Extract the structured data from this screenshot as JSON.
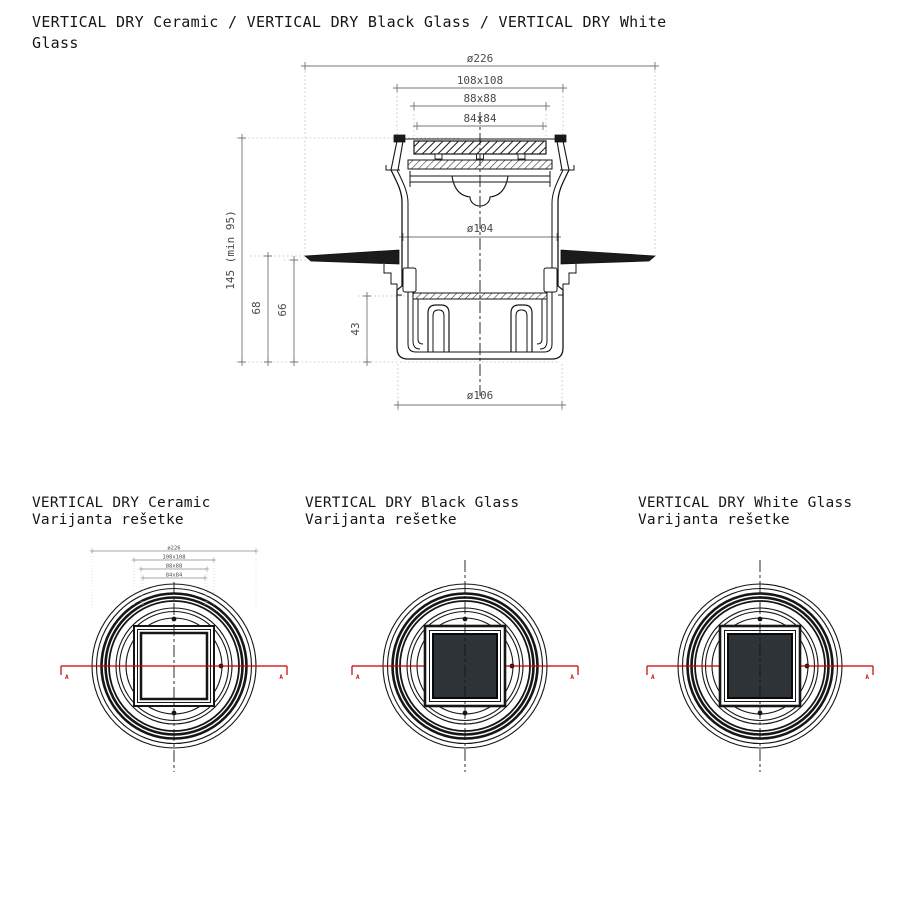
{
  "title": "VERTICAL DRY Ceramic / VERTICAL DRY Black Glass / VERTICAL DRY White Glass",
  "section_view": {
    "section_marker": "A",
    "dims": {
      "d226": "ø226",
      "s108": "108x108",
      "s88": "88x88",
      "s84": "84x84",
      "d104": "ø104",
      "d106": "ø106",
      "h145": "145 (min 95)",
      "h68": "68",
      "h66": "66",
      "h43": "43"
    }
  },
  "top_views": [
    {
      "title": "VERTICAL DRY Ceramic",
      "subtitle": "Varijanta rešetke",
      "grate": "ceramic",
      "dims_shown": true
    },
    {
      "title": "VERTICAL DRY Black Glass",
      "subtitle": "Varijanta rešetke",
      "grate": "glass",
      "dims_shown": false
    },
    {
      "title": "VERTICAL DRY White Glass",
      "subtitle": "Varijanta rešetke",
      "grate": "glass",
      "dims_shown": false
    }
  ],
  "colors": {
    "line": "#161616",
    "dim_line": "#757575",
    "dim_text": "#4a4a4a",
    "dotted": "#bbbbbb",
    "red": "#c40000",
    "glass_dark": "#2e3337",
    "hatch_dark": "#1b1b1b"
  }
}
